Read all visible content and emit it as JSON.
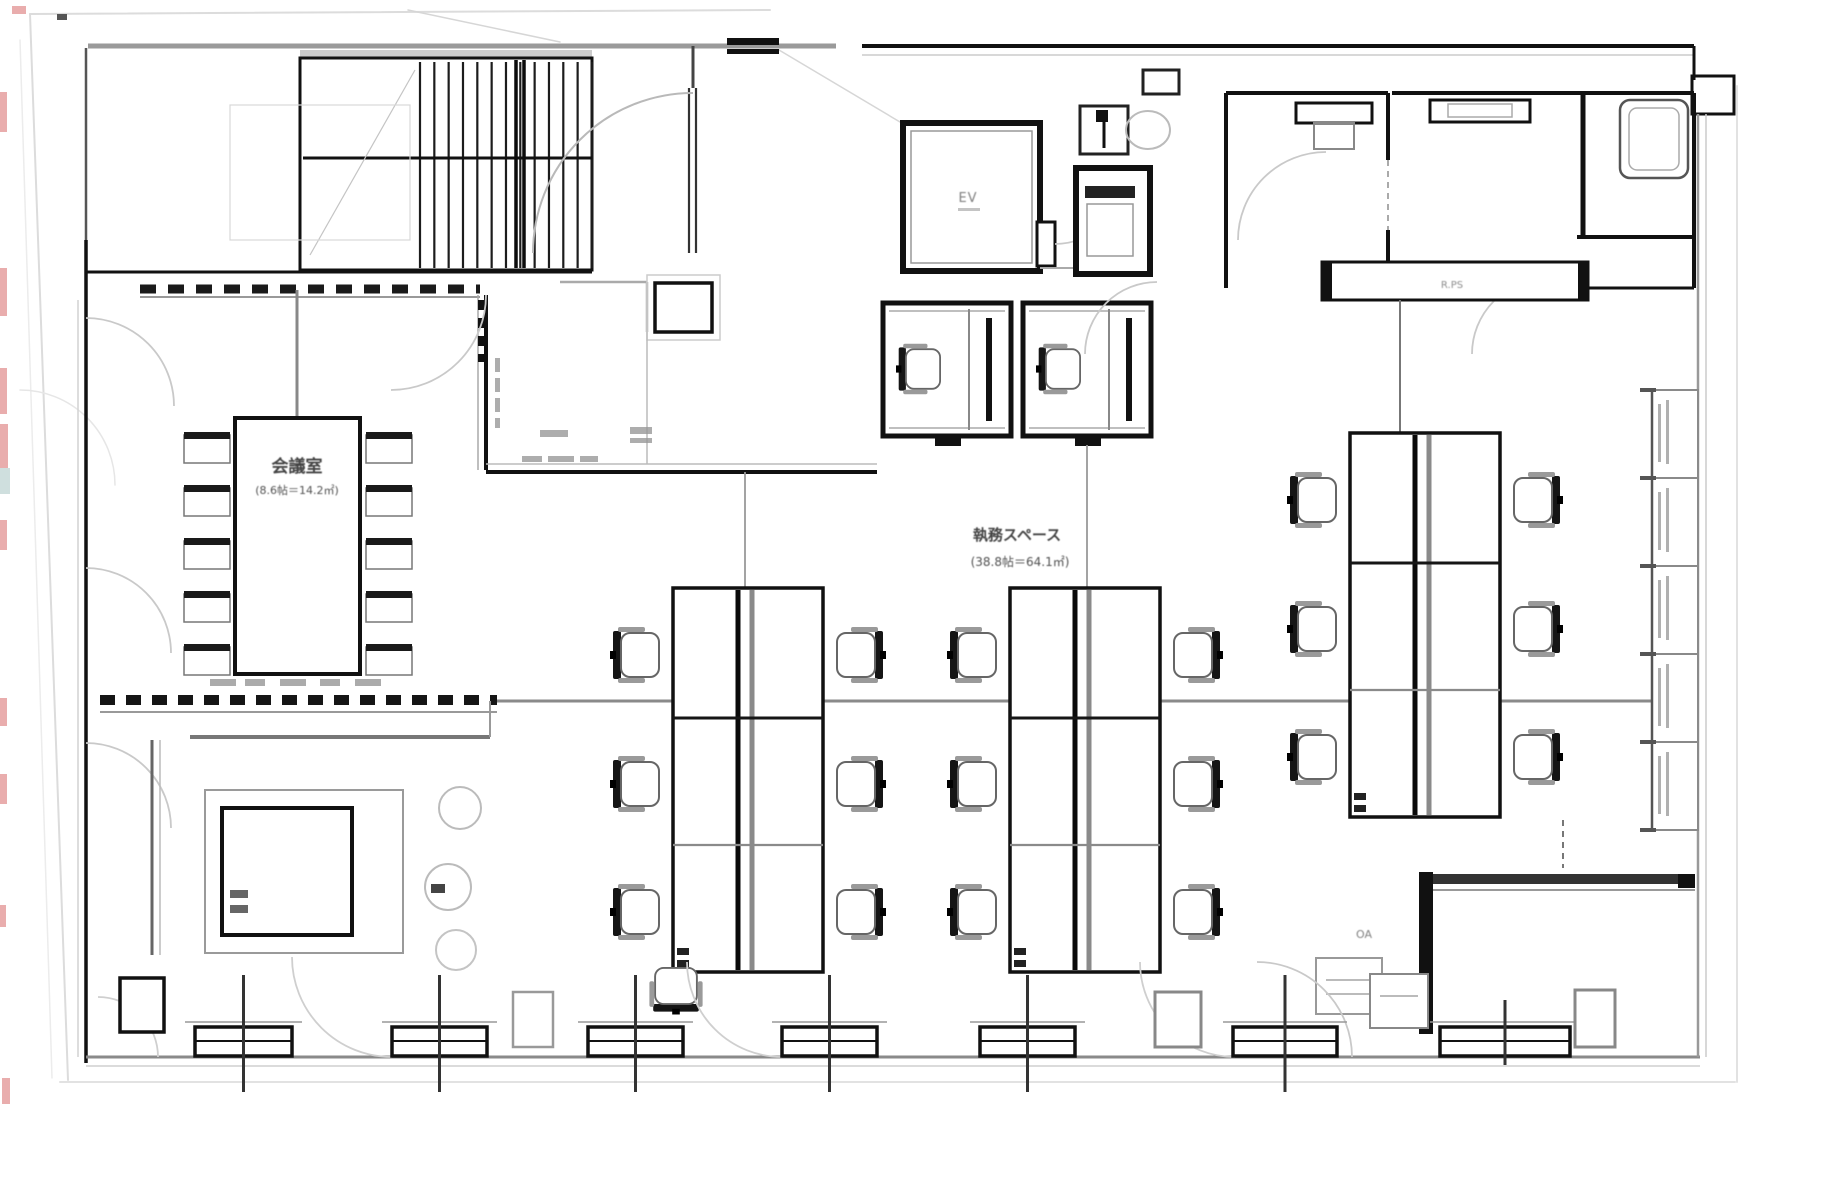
{
  "floor_plan": {
    "rooms": {
      "meeting_room": {
        "label": "会議室",
        "area_label": "(8.6帖＝14.2㎡)"
      },
      "office_area": {
        "label": "執務スペース",
        "area_label": "(38.8帖＝64.1㎡)"
      },
      "elevator": {
        "label": "EV"
      },
      "pipe_shaft": {
        "label": "R.PS"
      },
      "oa_corner": {
        "label": "OA"
      }
    },
    "palette": {
      "wall": "#111111",
      "mid_gray": "#8a8a8a",
      "light_gray": "#c9c9c9",
      "sketch": "#dcdcdc",
      "red_mark": "#e08a8a",
      "paper": "#ffffff"
    }
  }
}
